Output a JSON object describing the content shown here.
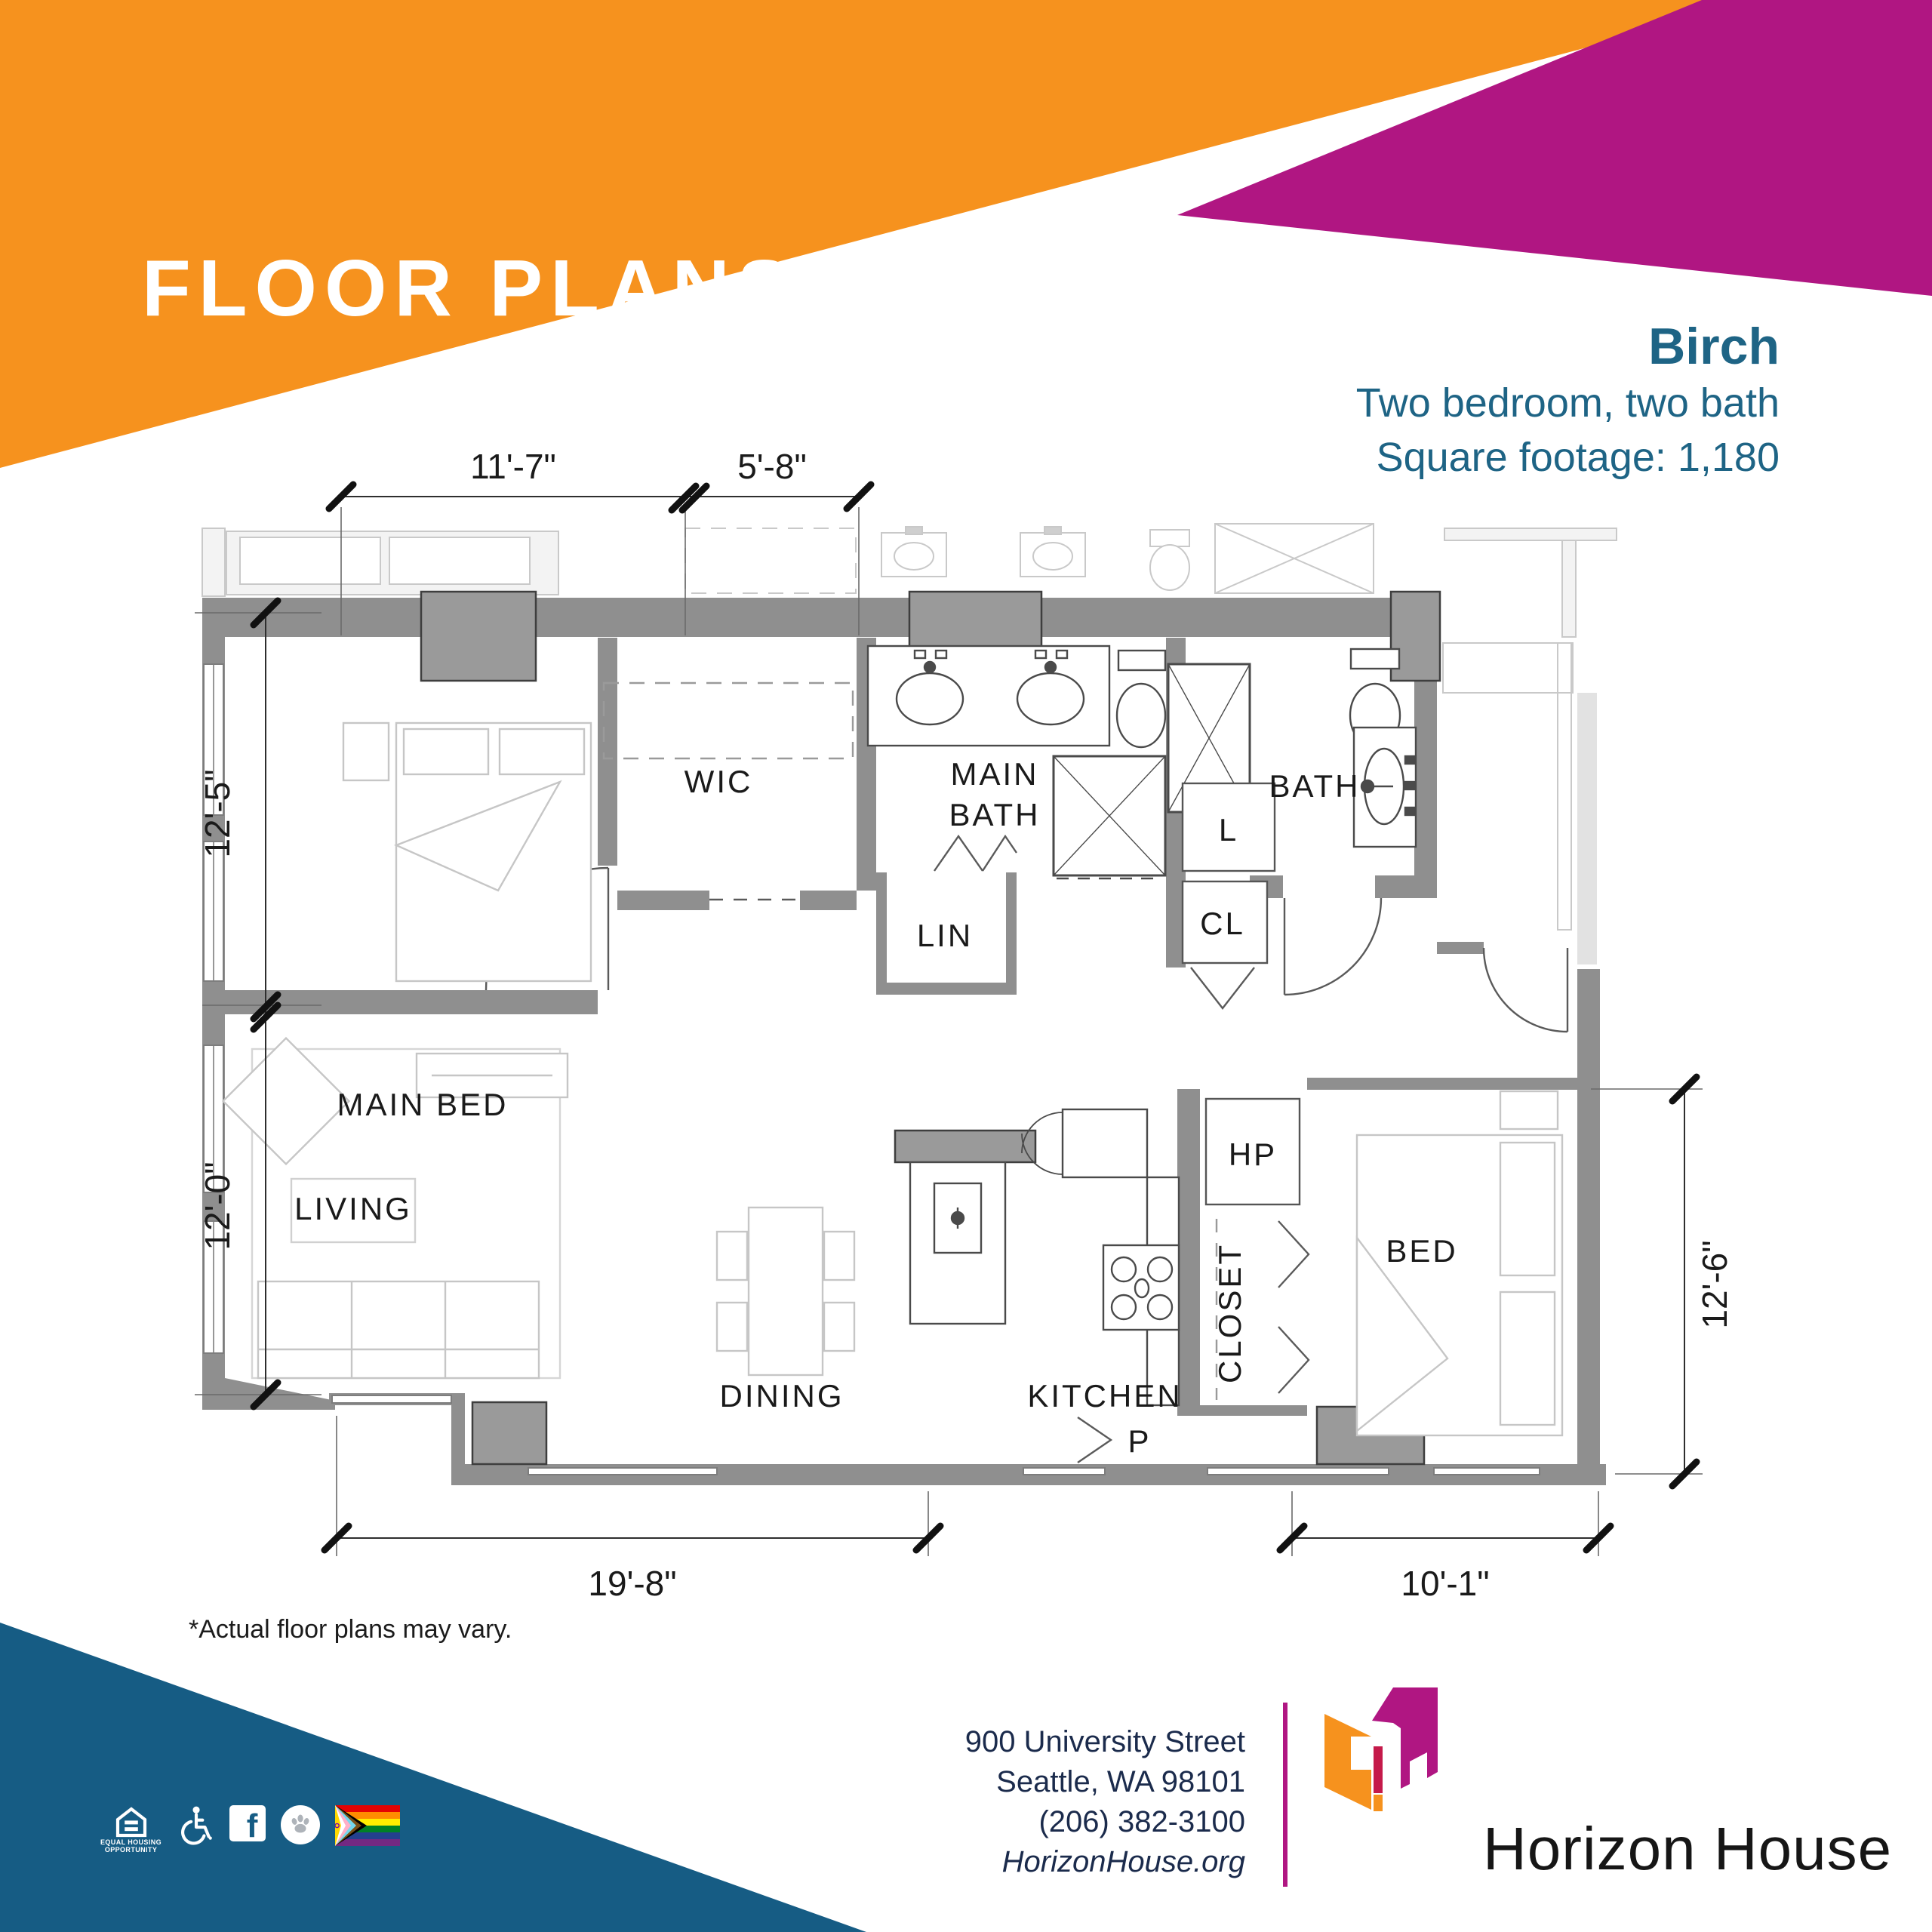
{
  "page": {
    "banner_title": "FLOOR PLANS",
    "disclaimer": "*Actual floor plans may vary."
  },
  "unit": {
    "name": "Birch",
    "description": "Two bedroom, two bath",
    "square_footage": "Square footage: 1,180"
  },
  "floor_plan": {
    "rooms": {
      "main_bed": "MAIN BED",
      "wic": "WIC",
      "main_bath_line1": "MAIN",
      "main_bath_line2": "BATH",
      "bath": "BATH",
      "lin": "LIN",
      "laundry": "L",
      "cl": "CL",
      "living": "LIVING",
      "dining": "DINING",
      "kitchen": "KITCHEN",
      "hp": "HP",
      "closet": "CLOSET",
      "bed": "BED",
      "pantry": "P"
    },
    "dimensions": {
      "top_left": "11'-7\"",
      "top_right": "5'-8\"",
      "left_upper": "12'-5\"",
      "left_lower": "12'-0\"",
      "bottom_left": "19'-8\"",
      "bottom_right": "10'-1\"",
      "right": "12'-6\""
    }
  },
  "footer": {
    "address_line1": "900 University Street",
    "address_line2": "Seattle, WA 98101",
    "phone": "(206) 382-3100",
    "website": "HorizonHouse.org",
    "logo_text": "Horizon House"
  },
  "icons": {
    "equal_housing_line1": "EQUAL HOUSING",
    "equal_housing_line2": "OPPORTUNITY",
    "facebook_letter": "f"
  },
  "colors": {
    "orange": "#F6921E",
    "magenta": "#B01682",
    "crimson": "#C51A4A",
    "navy_triangle": "#165C84",
    "heading_blue": "#1E6485",
    "footer_navy": "#1B2B4C",
    "wall_gray": "#8F8F8F",
    "pier_gray": "#9A9A9A",
    "neighbor_gray": "#EFEFEF"
  }
}
